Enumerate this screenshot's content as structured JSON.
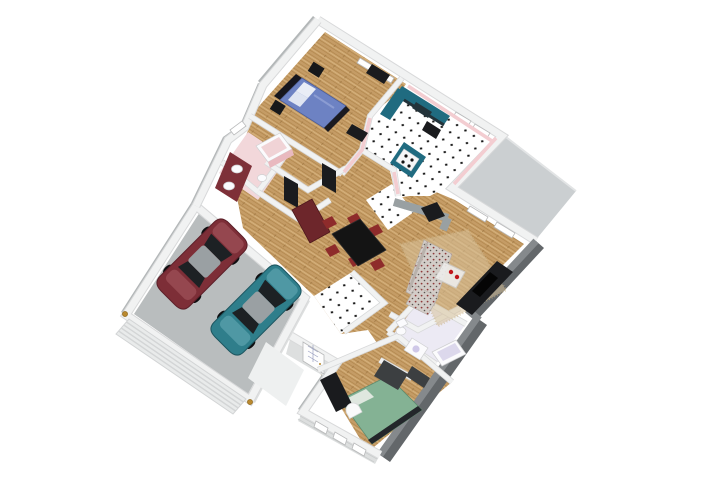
{
  "scene": {
    "title": "3D dollhouse-view floor plan rendering of a bungalow with attached two-car garage",
    "style": "isometric cutaway rendering with roof removed",
    "background": "#ffffff"
  },
  "palette": {
    "wallTop": "#f1f2f2",
    "wallEdge": "#d8d9da",
    "wallTopDark": "#85898c",
    "wallFaceDark": "#63676a",
    "wallFaceMid": "#b3b7b8",
    "wallFaceLight": "#dddfdf",
    "innerGray": "#99a0a2",
    "wood": "#c59c66",
    "woodStreak": "#ae8449",
    "woodLight": "#d6b27c",
    "tileWhite": "#ffffff",
    "tileDot": "#161616",
    "deck": "#cbcfd1",
    "garageFloor": "#b9bdbe",
    "porch": "#eef0f0",
    "pinkWall": "#f3cdd1",
    "pinkFloor": "#f2d7da",
    "teal": "#206b80",
    "counterTop": "#23333a",
    "bedBlue": "#6d82c3",
    "bedFrame": "#16161d",
    "bedGreen": "#84b294",
    "furnDark": "#1a1b1e",
    "furnGray": "#3c3f41",
    "maroon": "#7e3038",
    "hutch": "#6d262b",
    "chairRed": "#8e2b2b",
    "tableBlack": "#141414",
    "sofaBase": "#d3cdc8",
    "sofaRed": "#8d3a3a",
    "sofaDark": "#5b5550",
    "lavender": "#eceaf4",
    "fixtureWhite": "#fbfbfd",
    "carRed": "#7d2e37",
    "carRedLight": "#95474f",
    "carTeal": "#2f7e8b",
    "carTealLight": "#4f98a4",
    "carRoof": "#9aa0a3",
    "carGlass": "#1d2124",
    "gold": "#b9892f",
    "rug": "#d9c39c",
    "glassTable": "#edecea",
    "decorRed": "#c0161c"
  },
  "rooms": [
    {
      "name": "Master bedroom",
      "floor": "hardwood",
      "furniture": [
        "double bed with blue duvet",
        "dark headboard",
        "black nightstands",
        "black wardrobe",
        "dresser"
      ]
    },
    {
      "name": "Kitchen",
      "floor": "white tile with black diamond accents",
      "furniture": [
        "teal L-shaped counter with dark top",
        "sink",
        "black range",
        "teal island with white cooktop"
      ]
    },
    {
      "name": "Ensuite bathroom",
      "floor": "pink tile",
      "furniture": [
        "maroon vanity with two white sinks",
        "bathtub with pink apron",
        "toilet"
      ]
    },
    {
      "name": "Hallway",
      "floor": "hardwood",
      "furniture": [
        "dark closet doors"
      ]
    },
    {
      "name": "Dining room",
      "floor": "hardwood",
      "furniture": [
        "black dining table",
        "six dark red chairs",
        "maroon hutch",
        "black wood stove on gray half wall"
      ]
    },
    {
      "name": "Living room",
      "floor": "hardwood with area rug",
      "furniture": [
        "floral sofa",
        "floral armchair",
        "glass coffee table with red decor",
        "dark media cabinet"
      ]
    },
    {
      "name": "Entry foyer",
      "floor": "white tile with black diamond accents",
      "furniture": [
        "glazed front door"
      ]
    },
    {
      "name": "Main bathroom",
      "floor": "lavender tile",
      "furniture": [
        "toilet",
        "vanity with sink",
        "bathtub",
        "dark laundry unit"
      ]
    },
    {
      "name": "Second bedroom",
      "floor": "hardwood",
      "furniture": [
        "bed with green duvet",
        "black dresser",
        "media chest",
        "white arched decor"
      ]
    },
    {
      "name": "Garage",
      "floor": "concrete",
      "furniture": [
        "panelled garage door",
        "two brass carriage lamps"
      ]
    },
    {
      "name": "Deck",
      "floor": "gray decking",
      "furniture": []
    },
    {
      "name": "Porch",
      "floor": "concrete",
      "furniture": []
    }
  ],
  "vehicles": [
    {
      "type": "sedan",
      "color_name": "maroon"
    },
    {
      "type": "sedan",
      "color_name": "teal"
    }
  ]
}
